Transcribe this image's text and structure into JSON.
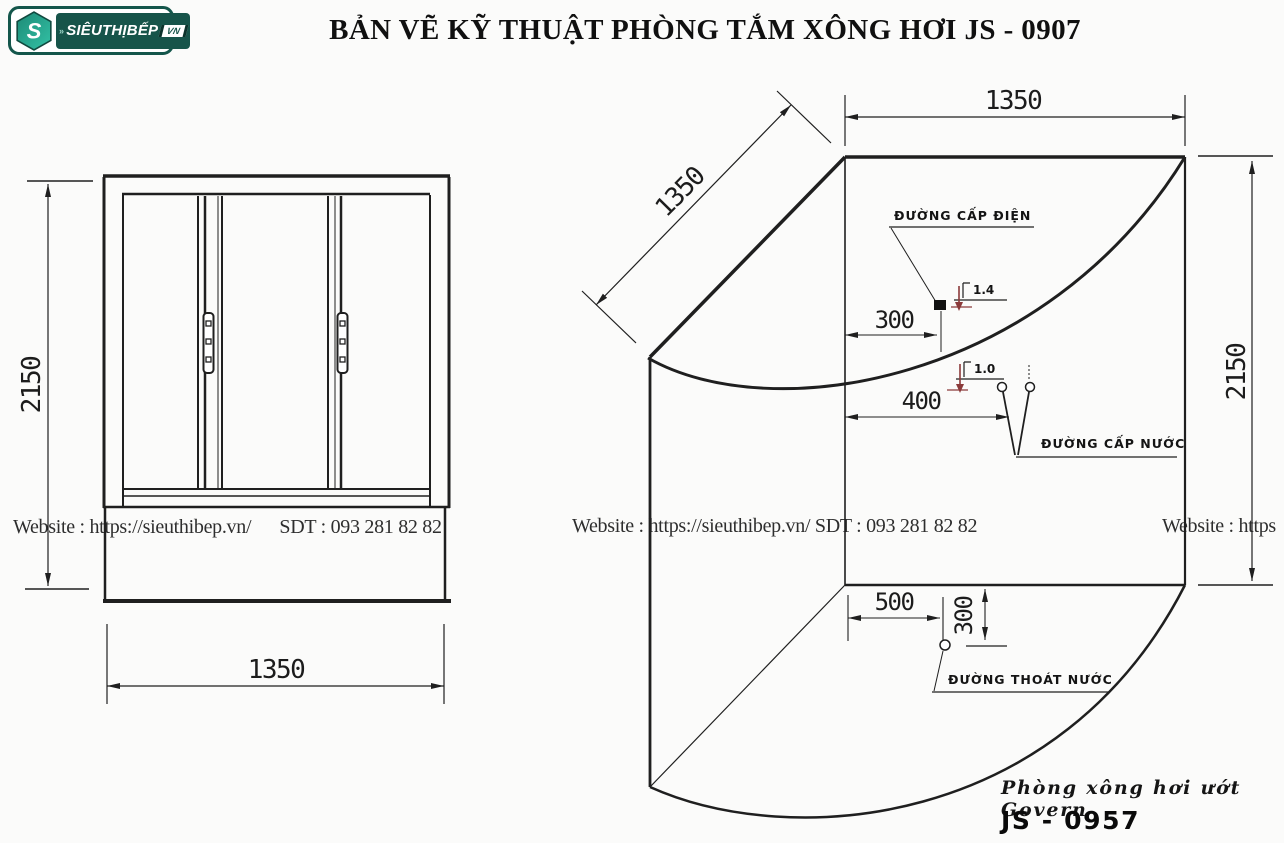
{
  "header": {
    "logo": {
      "chevron": "»",
      "brand": "SIÊUTHỊBẾP",
      "tld": "VN",
      "icon_letter": "S"
    },
    "title": "BẢN VẼ KỸ THUẬT PHÒNG TẮM XÔNG HƠI JS - 0907"
  },
  "front_view": {
    "height_dim": "2150",
    "width_dim": "1350"
  },
  "plan_view": {
    "width_dim": "1350",
    "depth_dim": "1350",
    "height_dim": "2150",
    "electric_label": "ĐƯỜNG CẤP ĐIỆN",
    "electric_offset": "300",
    "electric_height": "1.4",
    "water_label": "ĐƯỜNG CẤP NƯỚC",
    "water_offset": "400",
    "water_height": "1.0",
    "drain_label": "ĐƯỜNG THOÁT NƯỚC",
    "drain_offset_x": "500",
    "drain_offset_y": "300"
  },
  "watermarks": {
    "left": "Website : https://sieuthibep.vn/      SDT : 093 281 82 82",
    "middle": "Website : https://sieuthibep.vn/ SDT : 093 281 82 82",
    "right": "Website : https"
  },
  "footer": {
    "series": "Phòng xông hơi ướt Govern",
    "model": "JS - 0957"
  },
  "colors": {
    "line": "#1f1f1f",
    "accent_red": "#8b3a3a",
    "logo_dark": "#17544a",
    "logo_teal": "#2bb199"
  }
}
